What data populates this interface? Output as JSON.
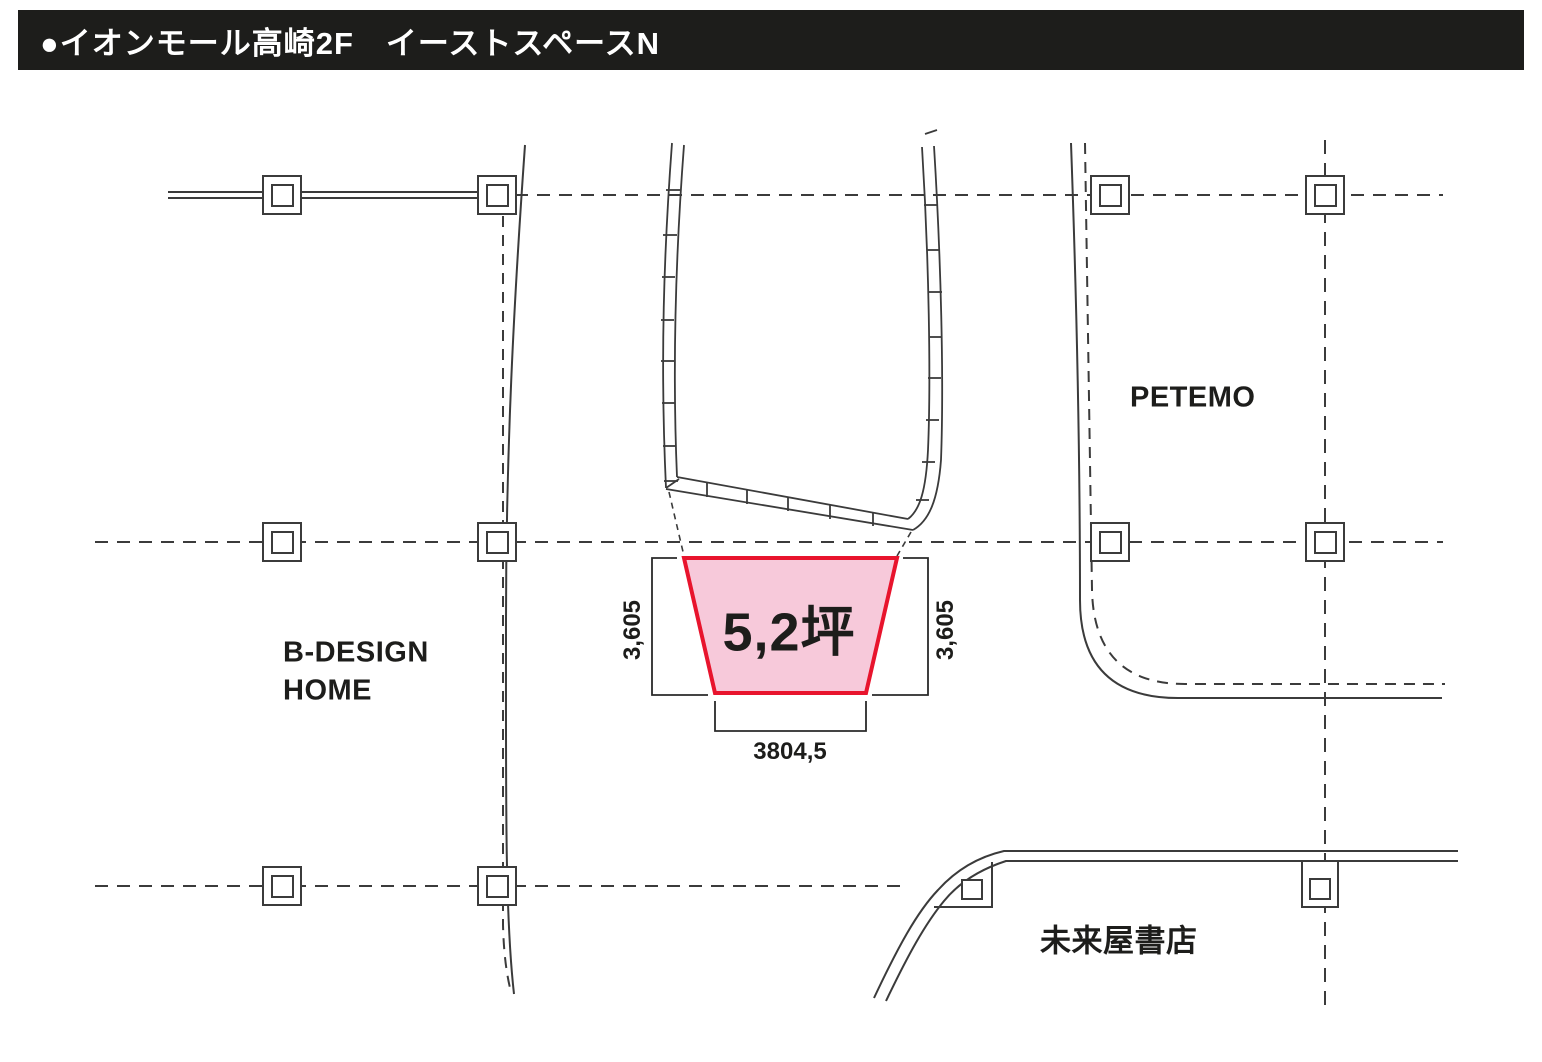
{
  "header": {
    "title": "●イオンモール高崎2F　イーストスペースN",
    "bg_color": "#1d1d1b",
    "text_color": "#ffffff"
  },
  "unit": {
    "area_label": "5,2坪",
    "dim_left": "3,605",
    "dim_right": "3,605",
    "dim_bottom": "3804,5",
    "fill": "#f7c9da",
    "stroke": "#e8142d"
  },
  "stores": {
    "b_design_line1": "B-DESIGN",
    "b_design_line2": "HOME",
    "petemo": "PETEMO",
    "miraiya": "未来屋書店"
  },
  "colors": {
    "plan_line": "#3b3b3b",
    "text": "#1d1d1b"
  }
}
